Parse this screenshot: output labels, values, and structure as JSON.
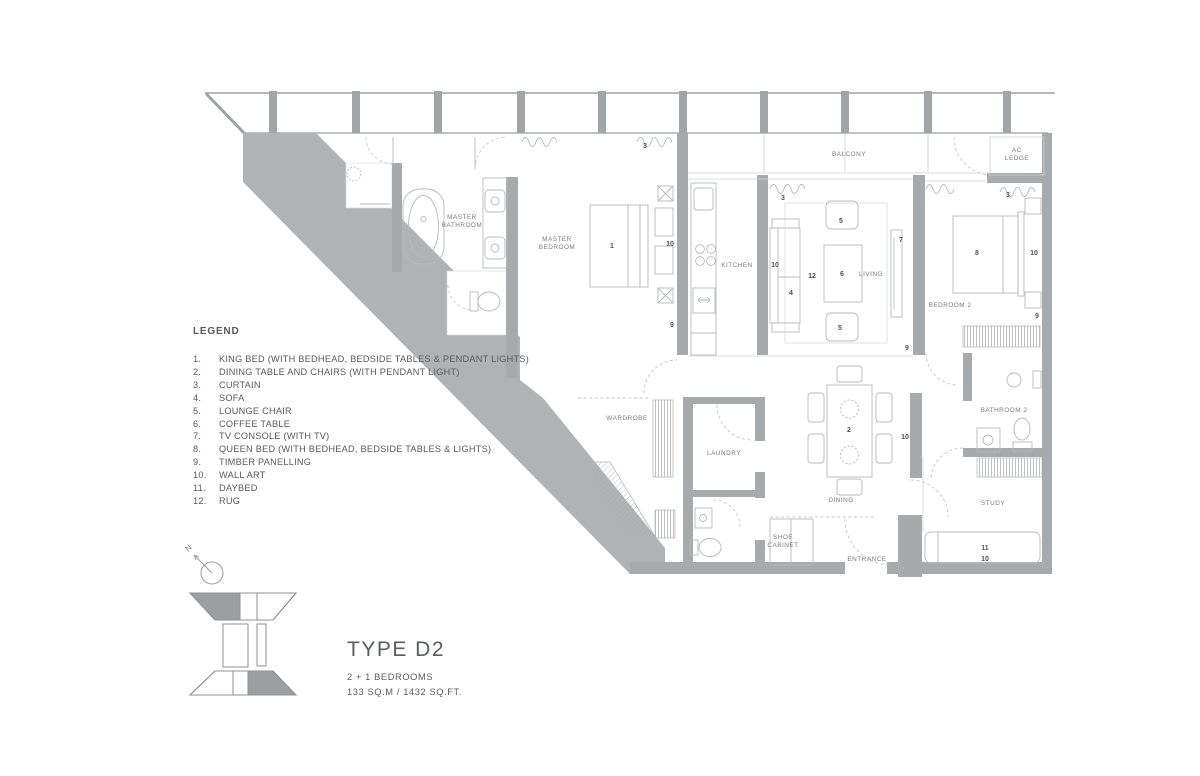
{
  "colors": {
    "wall": "#b0b3b5",
    "wall_dark": "#a7aaac",
    "line": "#9fa2a5",
    "furn": "#b7babc",
    "light": "#cfd1d3",
    "text": "#58595b",
    "label": "#797c7e",
    "keyfill": "#9c9fa2",
    "hatch": "#a4a7aa"
  },
  "title_block": {
    "type_name": "TYPE D2",
    "bedrooms": "2 + 1 BEDROOMS",
    "area": "133 SQ.M / 1432 SQ.FT."
  },
  "north_label": "N",
  "legend": {
    "heading": "LEGEND",
    "items": [
      {
        "n": "1.",
        "label": "KING BED (WITH BEDHEAD, BEDSIDE TABLES & PENDANT LIGHTS)"
      },
      {
        "n": "2.",
        "label": "DINING TABLE AND CHAIRS (WITH PENDANT LIGHT)"
      },
      {
        "n": "3.",
        "label": "CURTAIN"
      },
      {
        "n": "4.",
        "label": "SOFA"
      },
      {
        "n": "5.",
        "label": "LOUNGE CHAIR"
      },
      {
        "n": "6.",
        "label": "COFFEE TABLE"
      },
      {
        "n": "7.",
        "label": "TV CONSOLE (WITH TV)"
      },
      {
        "n": "8.",
        "label": "QUEEN BED (WITH BEDHEAD, BEDSIDE TABLES & LIGHTS)"
      },
      {
        "n": "9.",
        "label": "TIMBER PANELLING"
      },
      {
        "n": "10.",
        "label": "WALL ART"
      },
      {
        "n": "11.",
        "label": "DAYBED"
      },
      {
        "n": "12.",
        "label": "RUG"
      }
    ]
  },
  "plan": {
    "rooms": [
      {
        "id": "master-bathroom",
        "lines": [
          "MASTER",
          "BATHROOM"
        ],
        "x": 462,
        "y": 219
      },
      {
        "id": "master-bedroom",
        "lines": [
          "MASTER",
          "BEDROOM"
        ],
        "x": 557,
        "y": 241
      },
      {
        "id": "kitchen",
        "lines": [
          "KITCHEN"
        ],
        "x": 737,
        "y": 267
      },
      {
        "id": "living",
        "lines": [
          "LIVING"
        ],
        "x": 871,
        "y": 276
      },
      {
        "id": "balcony",
        "lines": [
          "BALCONY"
        ],
        "x": 849,
        "y": 156
      },
      {
        "id": "ac-ledge",
        "lines": [
          "AC",
          "LEDGE"
        ],
        "x": 1017,
        "y": 152
      },
      {
        "id": "bedroom-2",
        "lines": [
          "BEDROOM 2"
        ],
        "x": 950,
        "y": 307
      },
      {
        "id": "wardrobe",
        "lines": [
          "WARDROBE"
        ],
        "x": 627,
        "y": 420
      },
      {
        "id": "laundry",
        "lines": [
          "LAUNDRY"
        ],
        "x": 724,
        "y": 455
      },
      {
        "id": "dining",
        "lines": [
          "DINING"
        ],
        "x": 841,
        "y": 502
      },
      {
        "id": "bathroom-2",
        "lines": [
          "BATHROOM 2"
        ],
        "x": 1004,
        "y": 412
      },
      {
        "id": "study",
        "lines": [
          "STUDY"
        ],
        "x": 993,
        "y": 505
      },
      {
        "id": "shoe-cabinet",
        "lines": [
          "SHOE",
          "CABINET"
        ],
        "x": 783,
        "y": 539
      },
      {
        "id": "entrance",
        "lines": [
          "ENTRANCE"
        ],
        "x": 867,
        "y": 561
      }
    ],
    "markers": [
      {
        "n": "3",
        "x": 645,
        "y": 148
      },
      {
        "n": "1",
        "x": 612,
        "y": 248
      },
      {
        "n": "10",
        "x": 670,
        "y": 246
      },
      {
        "n": "9",
        "x": 672,
        "y": 327
      },
      {
        "n": "3",
        "x": 783,
        "y": 200
      },
      {
        "n": "10",
        "x": 775,
        "y": 267
      },
      {
        "n": "4",
        "x": 791,
        "y": 295
      },
      {
        "n": "12",
        "x": 812,
        "y": 278
      },
      {
        "n": "6",
        "x": 842,
        "y": 276
      },
      {
        "n": "5",
        "x": 841,
        "y": 223
      },
      {
        "n": "5",
        "x": 840,
        "y": 330
      },
      {
        "n": "7",
        "x": 901,
        "y": 242
      },
      {
        "n": "3",
        "x": 1008,
        "y": 197
      },
      {
        "n": "8",
        "x": 977,
        "y": 255
      },
      {
        "n": "10",
        "x": 1034,
        "y": 255
      },
      {
        "n": "9",
        "x": 1037,
        "y": 318
      },
      {
        "n": "9",
        "x": 907,
        "y": 350
      },
      {
        "n": "2",
        "x": 849,
        "y": 432
      },
      {
        "n": "10",
        "x": 905,
        "y": 439
      },
      {
        "n": "11",
        "x": 985,
        "y": 550
      },
      {
        "n": "10",
        "x": 985,
        "y": 561
      }
    ]
  }
}
